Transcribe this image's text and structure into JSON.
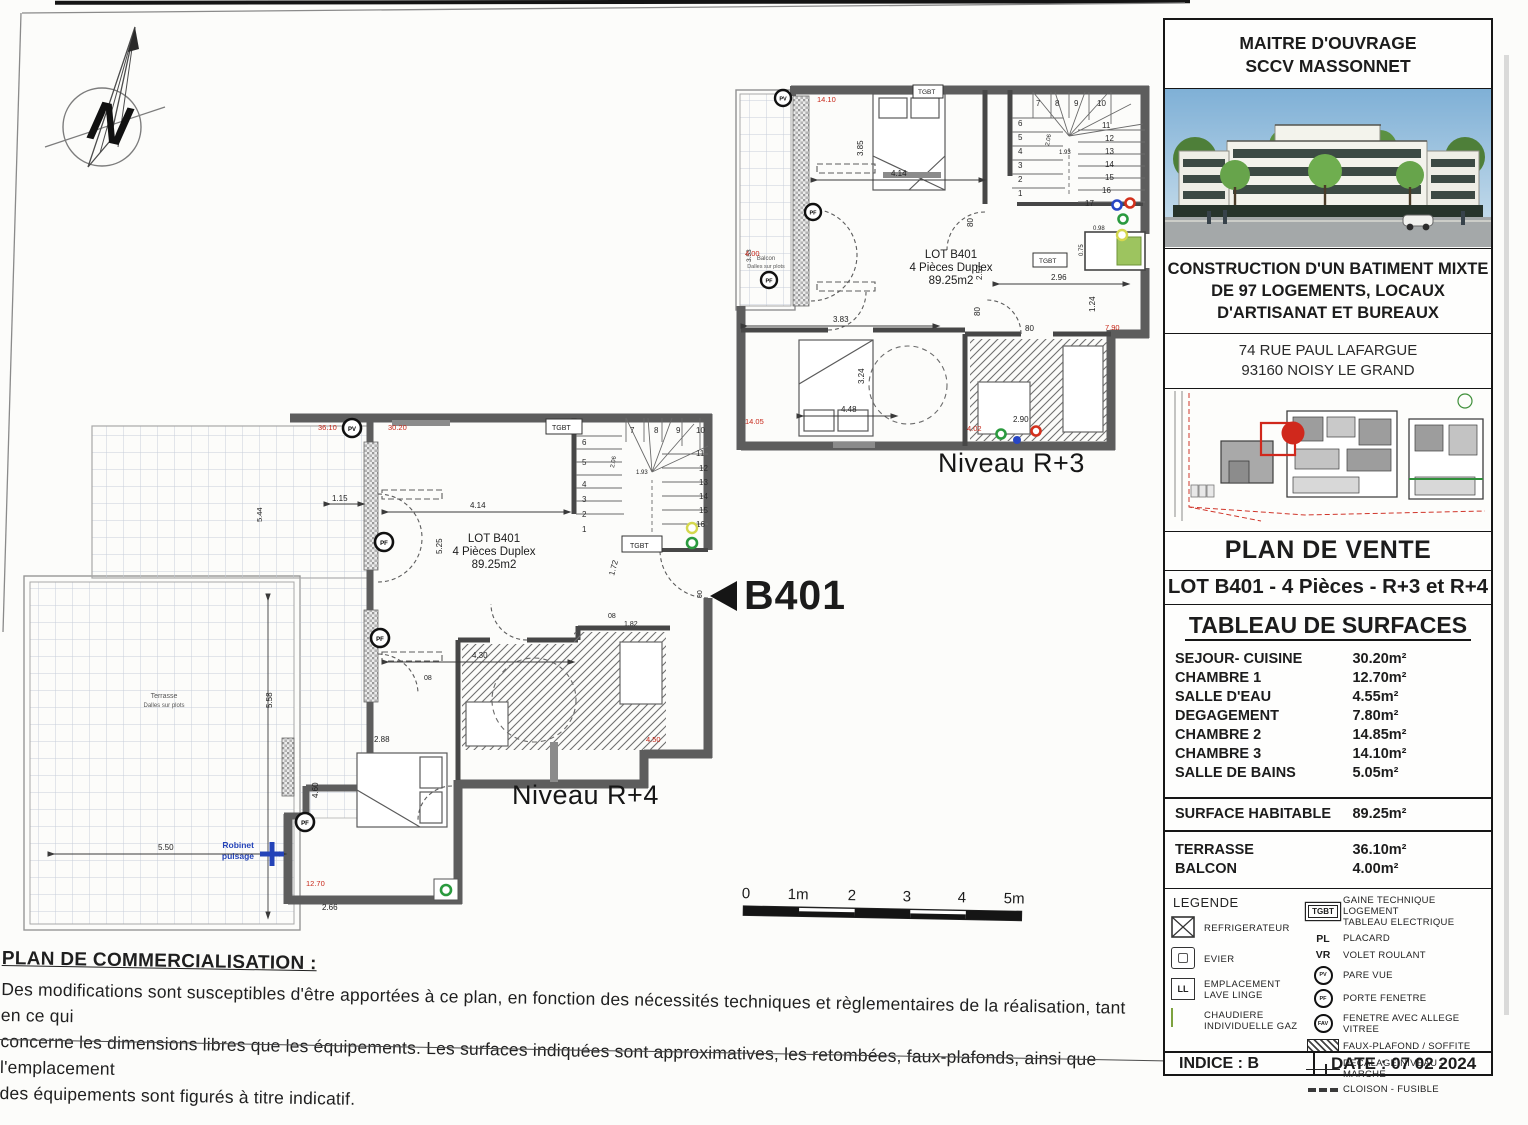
{
  "page": {
    "niveau_r3": "Niveau R+3",
    "niveau_r4": "Niveau R+4",
    "scale": [
      "0",
      "1m",
      "2",
      "3",
      "4",
      "5m"
    ]
  },
  "marker": {
    "label": "B401"
  },
  "sym": {
    "pv": "PV",
    "pf": "PF",
    "fav": "FAV",
    "tgbt": "TGBT",
    "n": "N"
  },
  "plan_r3": {
    "lot": [
      "LOT B401",
      "4 Pièces Duplex",
      "89.25m2"
    ],
    "balcon": [
      "Balcon",
      "Dalles sur plots"
    ],
    "dims": [
      "4.14",
      "3.85",
      "3.83",
      "3.24",
      "4.48",
      "2.57",
      "2.96",
      "1.24",
      "80",
      "80",
      "80",
      "2.90",
      "2.06",
      "1.93",
      "0.98",
      "0.75",
      "3.53"
    ],
    "red": [
      "14.10",
      "4.00",
      "14.05",
      "7.90",
      "4.02"
    ],
    "stairs": [
      "1",
      "2",
      "3",
      "4",
      "5",
      "6",
      "7",
      "8",
      "9",
      "10",
      "11",
      "12",
      "13",
      "14",
      "15",
      "16",
      "17"
    ]
  },
  "plan_r4": {
    "lot": [
      "LOT B401",
      "4 Pièces Duplex",
      "89.25m2"
    ],
    "terrasse": [
      "Terrasse",
      "Dalles sur plots"
    ],
    "robinet": [
      "Robinet",
      "puisage"
    ],
    "dims": [
      "4.14",
      "5.25",
      "4.30",
      "1.72",
      "1.82",
      "90",
      "08",
      "08",
      "2.88",
      "4.60",
      "2.66",
      "1.15",
      "5.44",
      "5.50",
      "5.58",
      "2.06",
      "1.93"
    ],
    "red": [
      "36.10",
      "30.20",
      "12.70",
      "4.50"
    ],
    "stairs": [
      "1",
      "2",
      "3",
      "4",
      "5",
      "6",
      "7",
      "8",
      "9",
      "10",
      "11",
      "12",
      "13",
      "14",
      "15",
      "16"
    ]
  },
  "commercial": {
    "title": "PLAN DE COMMERCIALISATION :",
    "line1": "Des modifications sont susceptibles d'être apportées à ce plan, en fonction des nécessités techniques et règlementaires de la réalisation, tant en ce qui",
    "line2": "concerne les dimensions libres que les équipements. Les surfaces indiquées sont approximatives, les retombées, faux-plafonds, ainsi que l'emplacement",
    "line3": "des équipements sont figurés à titre indicatif."
  },
  "titleblock": {
    "owner1": "MAITRE D'OUVRAGE",
    "owner2": "SCCV MASSONNET",
    "proj1": "CONSTRUCTION D'UN BATIMENT MIXTE",
    "proj2": "DE 97 LOGEMENTS, LOCAUX",
    "proj3": "D'ARTISANAT ET BUREAUX",
    "addr1": "74 RUE PAUL LAFARGUE",
    "addr2": "93160 NOISY LE GRAND",
    "plan_de_vente": "PLAN DE VENTE",
    "lot_title": "LOT B401 - 4 Pièces - R+3 et R+4",
    "surf_title": "TABLEAU DE SURFACES"
  },
  "surfaces": {
    "rows": [
      {
        "label": "SEJOUR- CUISINE",
        "value": "30.20m²"
      },
      {
        "label": "CHAMBRE 1",
        "value": "12.70m²"
      },
      {
        "label": "SALLE D'EAU",
        "value": "4.55m²"
      },
      {
        "label": "DEGAGEMENT",
        "value": "7.80m²"
      },
      {
        "label": "CHAMBRE 2",
        "value": "14.85m²"
      },
      {
        "label": "CHAMBRE 3",
        "value": "14.10m²"
      },
      {
        "label": "SALLE DE BAINS",
        "value": "5.05m²"
      }
    ],
    "total": {
      "label": "SURFACE HABITABLE",
      "value": "89.25m²"
    },
    "ext": [
      {
        "label": "TERRASSE",
        "value": "36.10m²"
      },
      {
        "label": "BALCON",
        "value": "4.00m²"
      }
    ]
  },
  "legend": {
    "title": "LEGENDE",
    "left": [
      {
        "l1": "REFRIGERATEUR",
        "l2": ""
      },
      {
        "l1": "EVIER",
        "l2": ""
      },
      {
        "l1": "EMPLACEMENT",
        "l2": "LAVE LINGE"
      },
      {
        "l1": "CHAUDIERE",
        "l2": "INDIVIDUELLE GAZ"
      }
    ],
    "ll": "LL",
    "right": [
      {
        "sym": "TGBT",
        "l1": "GAINE TECHNIQUE LOGEMENT",
        "l2": "TABLEAU ELECTRIQUE"
      },
      {
        "sym": "PL",
        "l1": "PLACARD"
      },
      {
        "sym": "VR",
        "l1": "VOLET ROULANT"
      },
      {
        "sym": "PV",
        "l1": "PARE VUE"
      },
      {
        "sym": "PF",
        "l1": "PORTE FENETRE"
      },
      {
        "sym": "FAV",
        "l1": "FENETRE AVEC ALLEGE VITREE"
      },
      {
        "l1": "FAUX-PLAFOND / SOFFITE"
      },
      {
        "l1": "DECALAGE NIVEAU - MARCHE"
      },
      {
        "l1": "CLOISON - FUSIBLE"
      }
    ]
  },
  "footer": {
    "indice": "INDICE : B",
    "date": "DATE : 07 02 2024"
  },
  "colors": {
    "accent_red": "#c7281a",
    "boiler_green": "#9dc45f",
    "robinet_blue": "#2443b8",
    "wall_gray": "#5d5d5d"
  }
}
